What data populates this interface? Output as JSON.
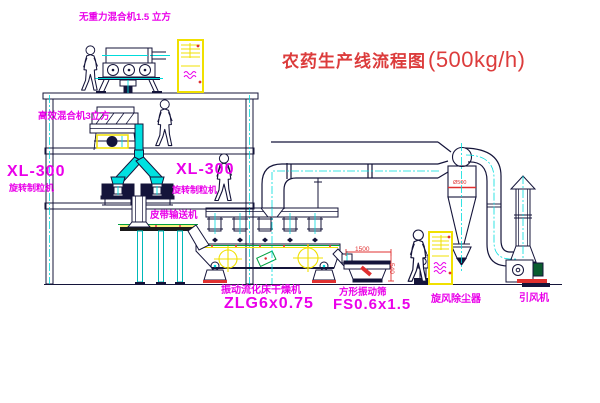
{
  "title": {
    "name_cn": "农药生产线流程图",
    "capacity": "(500kg/h)"
  },
  "equipment_labels": {
    "gravity_mixer": "无重力混合机1.5 立方",
    "high_eff_mixer": "高效混合机3立方",
    "granulator_left": {
      "model": "XL-300",
      "name": "旋转制粒机"
    },
    "granulator_mid": {
      "model": "XL-300",
      "name": "旋转制粒机"
    },
    "belt_conveyor": "皮带输送机",
    "fluid_bed_dryer": {
      "name": "振动流化床干燥机",
      "model": "ZLG6x0.75"
    },
    "square_sieve": {
      "name": "方形振动筛",
      "model": "FS0.6x1.5"
    },
    "cyclone_dust_collector": "旋风除尘器",
    "induced_draft_fan": "引风机"
  },
  "dimension_annotations": {
    "sieve_length": "1500",
    "sieve_height": "540",
    "cyclone_marking": "Ø500"
  },
  "colors": {
    "line": "#14143a",
    "label_magenta": "#ea00ea",
    "title_red": "#dc3c3c",
    "dimension_red": "#e03030",
    "centerline_cyan": "#00dcdc",
    "pipe_cyan": "#00e0e0",
    "cabinet_yellow": "#f0e000",
    "conveyor_green": "#00a040"
  }
}
